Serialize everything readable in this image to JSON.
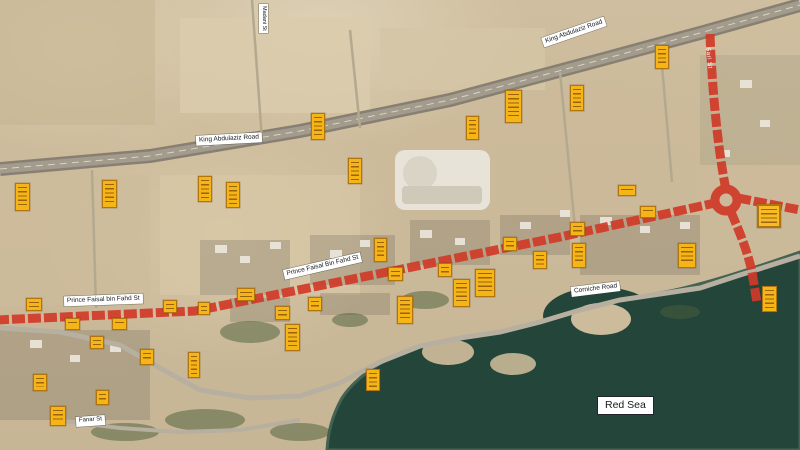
{
  "map": {
    "title": "Satellite map with surveyed road corridor and count markers",
    "sea_label": "Red Sea"
  },
  "labels": {
    "road_king_abdulaziz_left": "King Abdulaziz Road",
    "road_king_abdulaziz_right": "King Abdulaziz Road",
    "road_prince_faisal_left": "Prince Faisal bin Fahd St",
    "road_prince_faisal_mid": "Prince Faisal Bin Fahd St",
    "road_corniche": "Corniche Road",
    "sea": "Red Sea",
    "street_vertical_top": "Madani St",
    "street_bottom_left": "Fanar St",
    "street_red_vertical": "Sari St"
  },
  "colors": {
    "route_highlight": "#d03a28",
    "marker_fill": "#f6b517",
    "marker_border": "#b07410",
    "water": "#24453a",
    "sand": "#cfbe9f",
    "highway_gray": "#878072",
    "label_bg": "#ffffff"
  },
  "markers": [
    {
      "x": 15,
      "y": 183,
      "w": 15,
      "h": 28
    },
    {
      "x": 102,
      "y": 180,
      "w": 15,
      "h": 28
    },
    {
      "x": 198,
      "y": 176,
      "w": 14,
      "h": 26
    },
    {
      "x": 226,
      "y": 182,
      "w": 14,
      "h": 26
    },
    {
      "x": 311,
      "y": 113,
      "w": 14,
      "h": 27
    },
    {
      "x": 348,
      "y": 158,
      "w": 14,
      "h": 26
    },
    {
      "x": 374,
      "y": 238,
      "w": 13,
      "h": 24
    },
    {
      "x": 466,
      "y": 116,
      "w": 13,
      "h": 24
    },
    {
      "x": 505,
      "y": 90,
      "w": 17,
      "h": 33
    },
    {
      "x": 570,
      "y": 85,
      "w": 14,
      "h": 26
    },
    {
      "x": 655,
      "y": 45,
      "w": 14,
      "h": 24
    },
    {
      "x": 618,
      "y": 185,
      "w": 18,
      "h": 11
    },
    {
      "x": 640,
      "y": 206,
      "w": 16,
      "h": 12
    },
    {
      "x": 570,
      "y": 222,
      "w": 15,
      "h": 14
    },
    {
      "x": 572,
      "y": 243,
      "w": 14,
      "h": 25
    },
    {
      "x": 678,
      "y": 243,
      "w": 18,
      "h": 25
    },
    {
      "x": 757,
      "y": 204,
      "w": 24,
      "h": 24,
      "big": true
    },
    {
      "x": 762,
      "y": 286,
      "w": 15,
      "h": 26
    },
    {
      "x": 26,
      "y": 298,
      "w": 16,
      "h": 13
    },
    {
      "x": 163,
      "y": 300,
      "w": 14,
      "h": 13
    },
    {
      "x": 65,
      "y": 318,
      "w": 15,
      "h": 12
    },
    {
      "x": 112,
      "y": 318,
      "w": 15,
      "h": 12
    },
    {
      "x": 90,
      "y": 336,
      "w": 14,
      "h": 13
    },
    {
      "x": 140,
      "y": 349,
      "w": 14,
      "h": 16
    },
    {
      "x": 33,
      "y": 374,
      "w": 14,
      "h": 17
    },
    {
      "x": 50,
      "y": 406,
      "w": 16,
      "h": 20
    },
    {
      "x": 96,
      "y": 390,
      "w": 13,
      "h": 15
    },
    {
      "x": 188,
      "y": 352,
      "w": 12,
      "h": 26
    },
    {
      "x": 198,
      "y": 302,
      "w": 12,
      "h": 13
    },
    {
      "x": 237,
      "y": 288,
      "w": 18,
      "h": 13
    },
    {
      "x": 275,
      "y": 306,
      "w": 15,
      "h": 14
    },
    {
      "x": 285,
      "y": 324,
      "w": 15,
      "h": 27
    },
    {
      "x": 308,
      "y": 297,
      "w": 14,
      "h": 14
    },
    {
      "x": 388,
      "y": 267,
      "w": 15,
      "h": 14
    },
    {
      "x": 397,
      "y": 296,
      "w": 16,
      "h": 28
    },
    {
      "x": 438,
      "y": 263,
      "w": 14,
      "h": 14
    },
    {
      "x": 453,
      "y": 279,
      "w": 17,
      "h": 28
    },
    {
      "x": 475,
      "y": 269,
      "w": 20,
      "h": 28
    },
    {
      "x": 503,
      "y": 237,
      "w": 14,
      "h": 14
    },
    {
      "x": 533,
      "y": 251,
      "w": 14,
      "h": 18
    },
    {
      "x": 366,
      "y": 369,
      "w": 14,
      "h": 22
    }
  ]
}
